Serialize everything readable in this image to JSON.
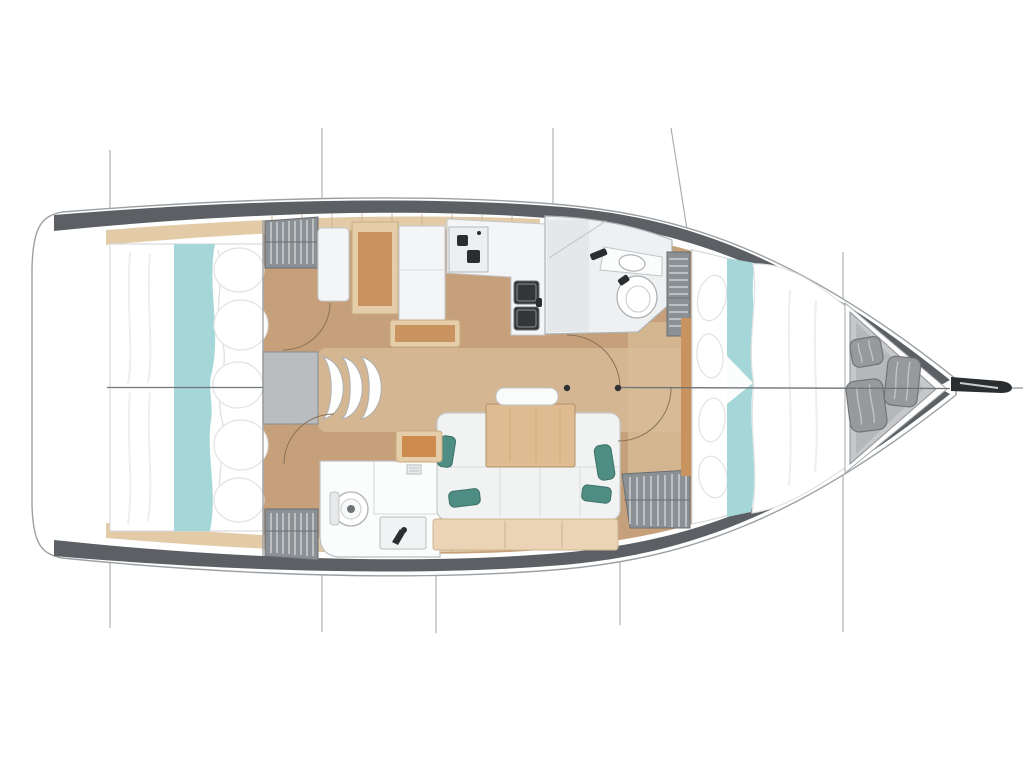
{
  "diagram": {
    "type": "sailboat-interior-floor-plan",
    "view": "top-down",
    "bow_direction": "right",
    "stern_direction": "left",
    "areas": [
      "aft-cabin-port-berth",
      "aft-cabin-starboard-berth",
      "companionway-steps",
      "nav-station",
      "galley",
      "forward-head",
      "aft-head",
      "saloon-table-and-settee",
      "forward-cabin-berth",
      "bow-sail-locker",
      "bowsprit-fitting"
    ],
    "counts": {
      "aft_cabins": 2,
      "heads": 2,
      "companionway_steps": 3,
      "bow_fenders": 3,
      "teal_cushions": 4,
      "louvered_lockers": 4,
      "vertical_section_lines": 7
    }
  },
  "palette": {
    "hull_outline": "#9aa0a3",
    "hull_band": "#5c6064",
    "deck_trim": "#e3cba8",
    "deck_trim_seam": "#c9ae8c",
    "floor": "#c5a07b",
    "floor_light": "#d8bd9a",
    "bed_white": "#ffffff",
    "bed_outline": "#d8dadc",
    "aqua": "#a6d7d8",
    "pillow_outline": "#e0e2e3",
    "teal": "#4e8d84",
    "teal_dark": "#3d7168",
    "locker": "#8b9094",
    "locker_slat": "#cdd0d2",
    "locker_edge": "#6a6e72",
    "fixture": "#f4f5f6",
    "fixture_edge": "#c6c9cc",
    "wood": "#c8935f",
    "wood_light": "#e5cda9",
    "table": "#debb90",
    "metal_dark": "#2b2e31",
    "section_line": "#a7a9ab",
    "center_line": "#70757a",
    "arc": "#8a7258",
    "sail_locker": "#c6c8ca",
    "sail_locker_floor": "#b5b7b9",
    "fender": "#98999b",
    "fender_edge": "#717477"
  }
}
